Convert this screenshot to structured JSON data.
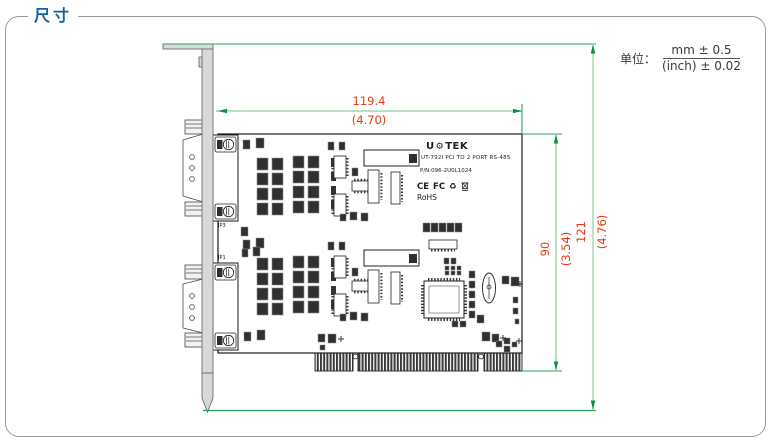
{
  "header": {
    "title": "尺寸"
  },
  "units": {
    "label": "单位：",
    "mm_tolerance": "mm ± 0.5",
    "inch_tolerance": "(inch) ± 0.02"
  },
  "dimensions": {
    "board_width": {
      "mm": "119.4",
      "inch": "(4.70)"
    },
    "board_height": {
      "mm": "90",
      "inch": "(3.54)"
    },
    "total_height": {
      "mm": "121",
      "inch": "(4.76)"
    }
  },
  "silkscreen": {
    "brand_prefix": "U",
    "gear_icon": "⚙",
    "brand_suffix": "TEK",
    "product_name": "UT-792I PCI TO 2 PORT RS-485",
    "part_number": "P/N:096-2U0L1024",
    "cert_ce": "CE",
    "cert_fcc": "FC",
    "cert_recycle": "♻",
    "rohs": "RoHS",
    "jumper_upper": "JP3",
    "jumper_lower": "JP1"
  },
  "colors": {
    "title_blue": "#155fa6",
    "dimension_text": "#e8380d",
    "dimension_line": "#9fd6ab",
    "extension_line": "#2ca05a",
    "arrow_green": "#0a9143",
    "bracket_gray": "#d8d8d8"
  }
}
